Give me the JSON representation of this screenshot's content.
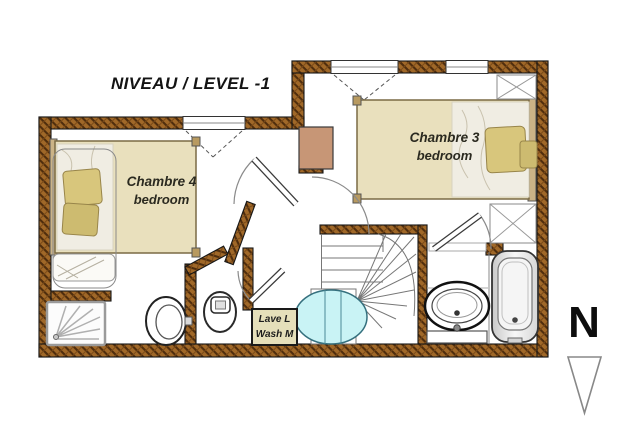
{
  "title": "NIVEAU / LEVEL -1",
  "rooms": {
    "chambre4": {
      "name": "Chambre 4",
      "type": "bedroom"
    },
    "chambre3": {
      "name": "Chambre 3",
      "type": "bedroom"
    }
  },
  "appliance_label": {
    "line1": "Lave L",
    "line2": "Wash M"
  },
  "compass": {
    "label": "N",
    "direction": "down"
  },
  "fixtures": [
    "double-bed",
    "double-bed",
    "closet",
    "closet",
    "winder-staircase",
    "shower-tray",
    "bidet",
    "toilet",
    "washbasin",
    "bathtub",
    "washing-machine",
    "chimney-block",
    "spa-cyan-fixture"
  ],
  "colors": {
    "wall_base": "#a06828",
    "wall_hatch": "#4f2d0d",
    "bed_fill": "#e9e0bd",
    "pillow": "#d8c67c",
    "cyan_fixture": "#c9f3f5",
    "chimney_block": "#c79676",
    "label_box": "#e5dfba",
    "text": "#141414"
  }
}
